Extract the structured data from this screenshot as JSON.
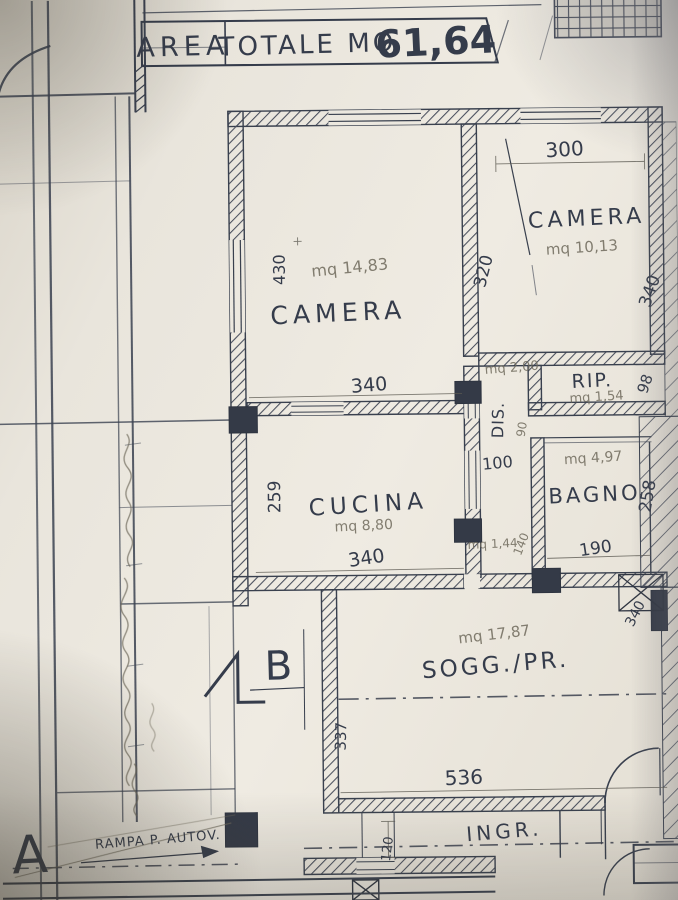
{
  "title": {
    "col1": "AREA",
    "col2": "TOTALE MQ",
    "value": "61,64"
  },
  "rooms": {
    "camera1": {
      "name": "CAMERA",
      "area": "mq 14,83",
      "dim_height": "430",
      "dim_width": "340"
    },
    "camera2": {
      "name": "CAMERA",
      "area": "mq 10,13",
      "dim_top": "300",
      "dim_left": "320",
      "dim_right": "340"
    },
    "rip": {
      "name": "RIP.",
      "area": "mq 1,54",
      "dim_right": "98"
    },
    "dis": {
      "name": "DIS.",
      "area": "mq 2,00",
      "dim_opening": "100",
      "dim_door": "90",
      "area_small": "mq 1,44",
      "dim_small": "140"
    },
    "bagno": {
      "name": "BAGNO",
      "area": "mq 4,97",
      "dim_right": "258",
      "dim_width": "190"
    },
    "cucina": {
      "name": "CUCINA",
      "area": "mq 8,80",
      "dim_left": "259",
      "dim_width": "340"
    },
    "sogg": {
      "name": "SOGG./PR.",
      "area": "mq 17,87",
      "dim_left": "337",
      "dim_width": "536",
      "dim_right": "340"
    },
    "ingr": {
      "name": "INGR.",
      "dim_door": "120"
    }
  },
  "markers": {
    "section_a": "A",
    "section_b": "B"
  },
  "annotations": {
    "rampa": "RAMPA P. AUTOV."
  },
  "colors": {
    "ink": "#3a4150",
    "pencil": "#6f6a5c",
    "paper": "#eae6dd"
  }
}
